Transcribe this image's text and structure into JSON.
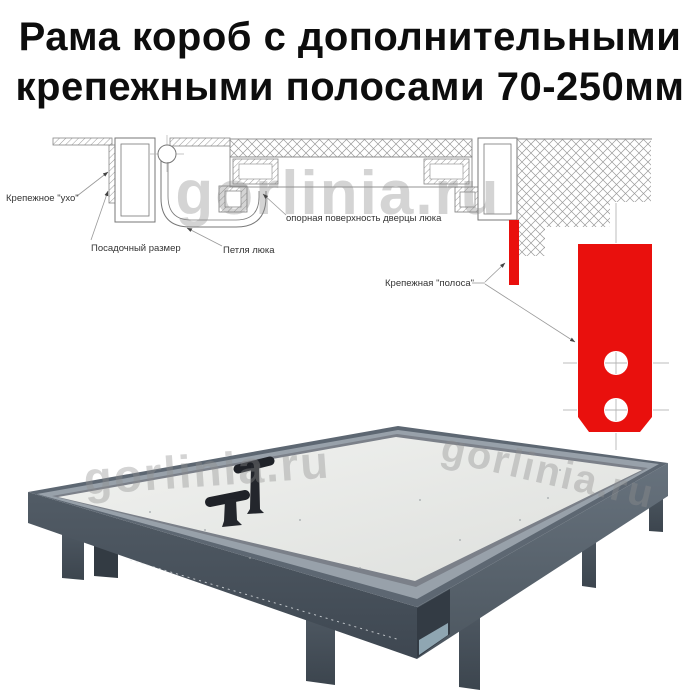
{
  "title": {
    "line1": "Рама короб с дополнительными",
    "line2": "крепежными полосами 70-250мм"
  },
  "watermark": {
    "text": "gorlinia.ru"
  },
  "colors": {
    "red": "#e9100d",
    "frame_dark": "#49535d",
    "frame_face_left": "#46505a",
    "frame_face_right": "#5d6872",
    "rim_silver": "#98a1aa",
    "panel": "#e9eae8",
    "drawing_line": "#7d7d7d",
    "label_text": "#333333"
  },
  "diagram": {
    "labels": {
      "ear": "Крепежное \"ухо\"",
      "seat": "Посадочный размер",
      "hinge": "Петля люка",
      "support": "опорная поверхность дверцы люка",
      "strip": "Крепежная \"полоса\""
    }
  }
}
